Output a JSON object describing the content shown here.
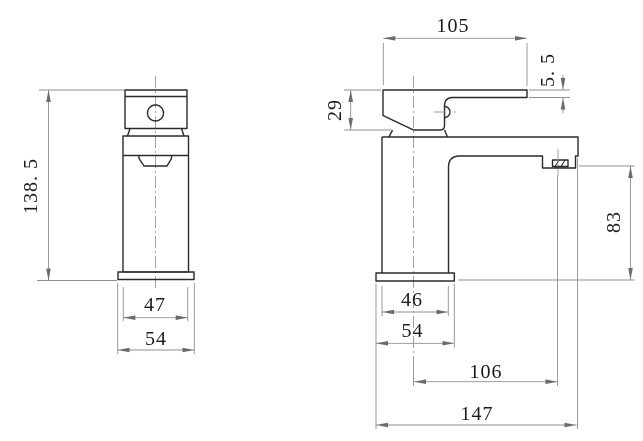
{
  "drawing": {
    "type": "faucet-technical-drawing-two-views",
    "units_shown": "mm",
    "colors": {
      "background": "#ffffff",
      "object_line": "#2a2a2a",
      "dimension_line": "#8f8f8f",
      "text": "#1c1c1c"
    },
    "dims": {
      "front": {
        "total_height": "138. 5",
        "body_width": "47",
        "base_width": "54"
      },
      "side": {
        "handle_length": "105",
        "lever_tip_thickness": "5. 5",
        "handle_height": "29",
        "spout_outlet_height": "83",
        "body_depth": "46",
        "base_depth": "54",
        "spout_reach_from_axis": "106",
        "overall_depth": "147"
      }
    }
  }
}
